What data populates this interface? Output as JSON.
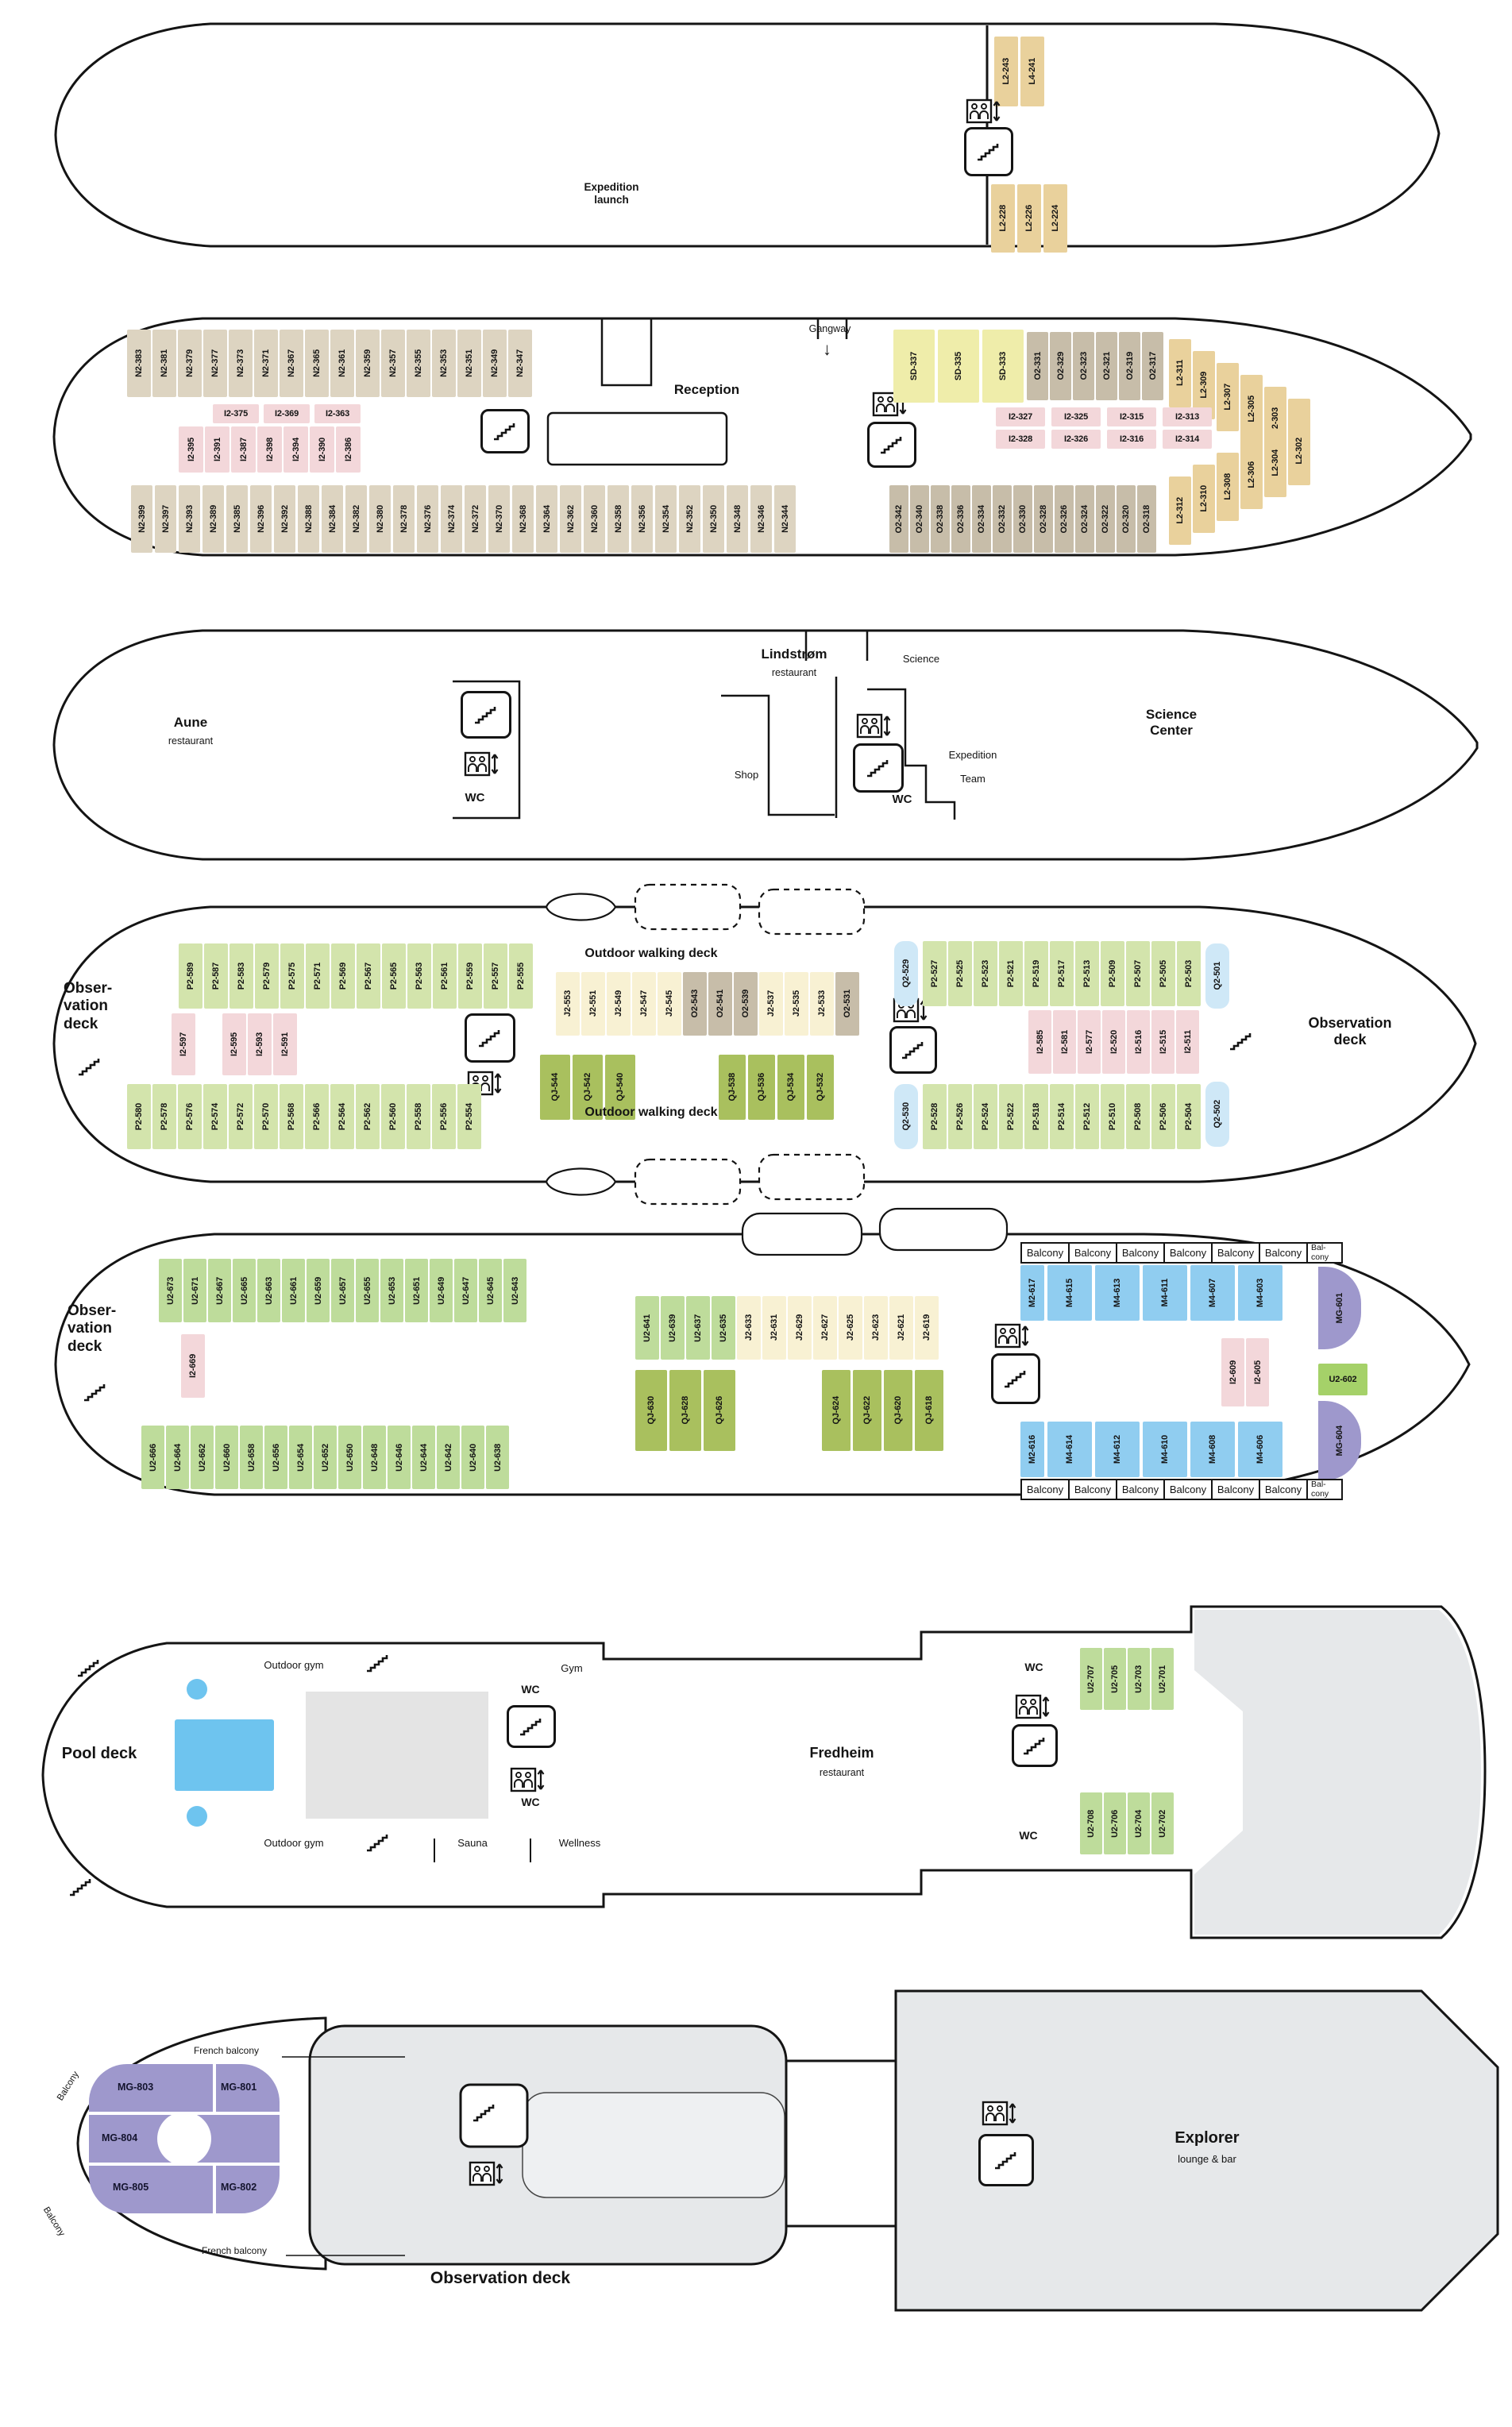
{
  "labels": {
    "expedition_launch": "Expedition\nlaunch",
    "gangway": "Gangway",
    "arrow_down": "↓",
    "reception": "Reception",
    "aune": "Aune",
    "restaurant": "restaurant",
    "lindstrom": "Lindstrøm",
    "shop": "Shop",
    "science": "Science",
    "expedition": "Expedition",
    "team": "Team",
    "wc": "WC",
    "science_center": "Science\nCenter",
    "outdoor_walking_deck": "Outdoor walking deck",
    "observation_wrap": "Obser-\nvation\ndeck",
    "observation_2l": "Observation\ndeck",
    "observation_deck": "Observation deck",
    "balcony": "Balcony",
    "balcony_2l": "Bal-\ncony",
    "french_balcony": "French balcony",
    "pool_deck": "Pool deck",
    "outdoor_gym": "Outdoor gym",
    "gym": "Gym",
    "fredheim": "Fredheim",
    "wellness": "Wellness",
    "sauna": "Sauna",
    "explorer": "Explorer",
    "lounge_bar": "lounge & bar"
  },
  "colors": {
    "L2": "#e9d19c",
    "L4": "#e9d19c",
    "N2": "#ddd4c1",
    "I2": "#f3d7da",
    "O2": "#c7bda9",
    "SD": "#efedaa",
    "J2": "#f8f1d3",
    "P2": "#d3e4ac",
    "U2": "#bedc9b",
    "QJ": "#a9c05e",
    "Q2": "#cfe8f7",
    "M2": "#90cdf0",
    "M4": "#90cdf0",
    "MG": "#9e98cc"
  },
  "groups": {
    "d1_fwd": {
      "cabins": [
        "L2-243",
        "L4-241"
      ]
    },
    "d1_aft": {
      "cabins": [
        "L2-228",
        "L2-226",
        "L2-224"
      ]
    },
    "d2_n_top": {
      "cabins": [
        "N2-383",
        "N2-381",
        "N2-379",
        "N2-377",
        "N2-373",
        "N2-371",
        "N2-367",
        "N2-365",
        "N2-361",
        "N2-359",
        "N2-357",
        "N2-355",
        "N2-353",
        "N2-351",
        "N2-349",
        "N2-347"
      ]
    },
    "d2_i_h": {
      "cabins": [
        "I2-375",
        "I2-369",
        "I2-363"
      ]
    },
    "d2_i_v": {
      "cabins": [
        "I2-395",
        "I2-391",
        "I2-387",
        "I2-398",
        "I2-394",
        "I2-390",
        "I2-386"
      ]
    },
    "d2_sd": {
      "cabins": [
        "SD-337",
        "SD-335",
        "SD-333"
      ]
    },
    "d2_o_top": {
      "cabins": [
        "O2-331",
        "O2-329",
        "O2-323",
        "O2-321",
        "O2-319",
        "O2-317"
      ]
    },
    "d2_l_top": {
      "cabins": [
        "L2-311",
        "L2-309",
        "L2-307",
        "L2-305",
        "L2-303",
        "L2-301"
      ]
    },
    "d2_i_row1": {
      "cabins": [
        "I2-327",
        "I2-325",
        "I2-315",
        "I2-313"
      ]
    },
    "d2_i_row2": {
      "cabins": [
        "I2-328",
        "I2-326",
        "I2-316",
        "I2-314"
      ]
    },
    "d2_n_bot": {
      "cabins": [
        "N2-399",
        "N2-397",
        "N2-393",
        "N2-389",
        "N2-385",
        "N2-396",
        "N2-392",
        "N2-388",
        "N2-384",
        "N2-382",
        "N2-380",
        "N2-378",
        "N2-376",
        "N2-374",
        "N2-372",
        "N2-370",
        "N2-368",
        "N2-364",
        "N2-362",
        "N2-360",
        "N2-358",
        "N2-356",
        "N2-354",
        "N2-352",
        "N2-350",
        "N2-348",
        "N2-346",
        "N2-344"
      ]
    },
    "d2_o_bot": {
      "cabins": [
        "O2-342",
        "O2-340",
        "O2-338",
        "O2-336",
        "O2-334",
        "O2-332",
        "O2-330",
        "O2-328",
        "O2-326",
        "O2-324",
        "O2-322",
        "O2-320",
        "O2-318"
      ]
    },
    "d2_l_bot": {
      "cabins": [
        "L2-312",
        "L2-310",
        "L2-308",
        "L2-306",
        "L2-304",
        "L2-302"
      ]
    },
    "d4_p_top": {
      "cabins": [
        "P2-589",
        "P2-587",
        "P2-583",
        "P2-579",
        "P2-575",
        "P2-571",
        "P2-569",
        "P2-567",
        "P2-565",
        "P2-563",
        "P2-561",
        "P2-559",
        "P2-557",
        "P2-555"
      ]
    },
    "d4_i_597": {
      "cabins": [
        "I2-597"
      ]
    },
    "d4_i_trio": {
      "cabins": [
        "I2-595",
        "I2-593",
        "I2-591"
      ]
    },
    "d4_j": {
      "cabins": [
        "J2-553",
        "J2-551",
        "J2-549",
        "J2-547",
        "J2-545",
        "O2-543",
        "O2-541",
        "O2-539",
        "J2-537",
        "J2-535",
        "J2-533",
        "O2-531"
      ]
    },
    "d4_qj_a": {
      "cabins": [
        "QJ-544",
        "QJ-542",
        "QJ-540"
      ]
    },
    "d4_qj_b": {
      "cabins": [
        "QJ-538",
        "QJ-536",
        "QJ-534",
        "QJ-532"
      ]
    },
    "d4_p_bot": {
      "cabins": [
        "P2-580",
        "P2-578",
        "P2-576",
        "P2-574",
        "P2-572",
        "P2-570",
        "P2-568",
        "P2-566",
        "P2-564",
        "P2-562",
        "P2-560",
        "P2-558",
        "P2-556",
        "P2-554"
      ]
    },
    "d4_q_529": {
      "cabins": [
        "Q2-529"
      ]
    },
    "d4_q_530": {
      "cabins": [
        "Q2-530"
      ]
    },
    "d4_p_rt": {
      "cabins": [
        "P2-527",
        "P2-525",
        "P2-523",
        "P2-521",
        "P2-519",
        "P2-517",
        "P2-513",
        "P2-509",
        "P2-507",
        "P2-505",
        "P2-503"
      ]
    },
    "d4_q_501": {
      "cabins": [
        "Q2-501"
      ]
    },
    "d4_i_rt": {
      "cabins": [
        "I2-585",
        "I2-581",
        "I2-577",
        "I2-520",
        "I2-516",
        "I2-515",
        "I2-511"
      ]
    },
    "d4_p_rb": {
      "cabins": [
        "P2-528",
        "P2-526",
        "P2-524",
        "P2-522",
        "P2-518",
        "P2-514",
        "P2-512",
        "P2-510",
        "P2-508",
        "P2-506",
        "P2-504"
      ]
    },
    "d4_q_502": {
      "cabins": [
        "Q2-502"
      ]
    },
    "d5_u_top": {
      "cabins": [
        "U2-673",
        "U2-671",
        "U2-667",
        "U2-665",
        "U2-663",
        "U2-661",
        "U2-659",
        "U2-657",
        "U2-655",
        "U2-653",
        "U2-651",
        "U2-649",
        "U2-647",
        "U2-645",
        "U2-643"
      ]
    },
    "d5_i_669": {
      "cabins": [
        "I2-669"
      ]
    },
    "d5_u_bot": {
      "cabins": [
        "U2-666",
        "U2-664",
        "U2-662",
        "U2-660",
        "U2-658",
        "U2-656",
        "U2-654",
        "U2-652",
        "U2-650",
        "U2-648",
        "U2-646",
        "U2-644",
        "U2-642",
        "U2-640",
        "U2-638"
      ]
    },
    "d5_mid": {
      "cabins": [
        "U2-641",
        "U2-639",
        "U2-637",
        "U2-635",
        "J2-633",
        "J2-631",
        "J2-629",
        "J2-627",
        "J2-625",
        "J2-623",
        "J2-621",
        "J2-619"
      ]
    },
    "d5_qj_a": {
      "cabins": [
        "QJ-630",
        "QJ-628",
        "QJ-626"
      ]
    },
    "d5_qj_b": {
      "cabins": [
        "QJ-624",
        "QJ-622",
        "QJ-620",
        "QJ-618"
      ]
    },
    "d5_m_top": {
      "cabins": [
        "M2-617",
        "M4-615",
        "M4-613",
        "M4-611",
        "M4-607",
        "M4-603"
      ]
    },
    "d5_mg_601": {
      "cabins": [
        "MG-601"
      ]
    },
    "d5_i_pair": {
      "cabins": [
        "I2-609",
        "I2-605"
      ]
    },
    "d5_u_602": {
      "color": "#a5d169",
      "cabins": [
        "U2-602"
      ]
    },
    "d5_mg_604": {
      "cabins": [
        "MG-604"
      ]
    },
    "d5_m_bot": {
      "cabins": [
        "M2-616",
        "M4-614",
        "M4-612",
        "M4-610",
        "M4-608",
        "M4-606"
      ]
    },
    "d6_u_top": {
      "cabins": [
        "U2-707",
        "U2-705",
        "U2-703",
        "U2-701"
      ]
    },
    "d6_u_bot": {
      "cabins": [
        "U2-708",
        "U2-706",
        "U2-704",
        "U2-702"
      ]
    },
    "d7_mg": {
      "cabins": [
        "MG-803",
        "MG-801",
        "MG-804",
        "MG-805",
        "MG-802"
      ]
    }
  }
}
